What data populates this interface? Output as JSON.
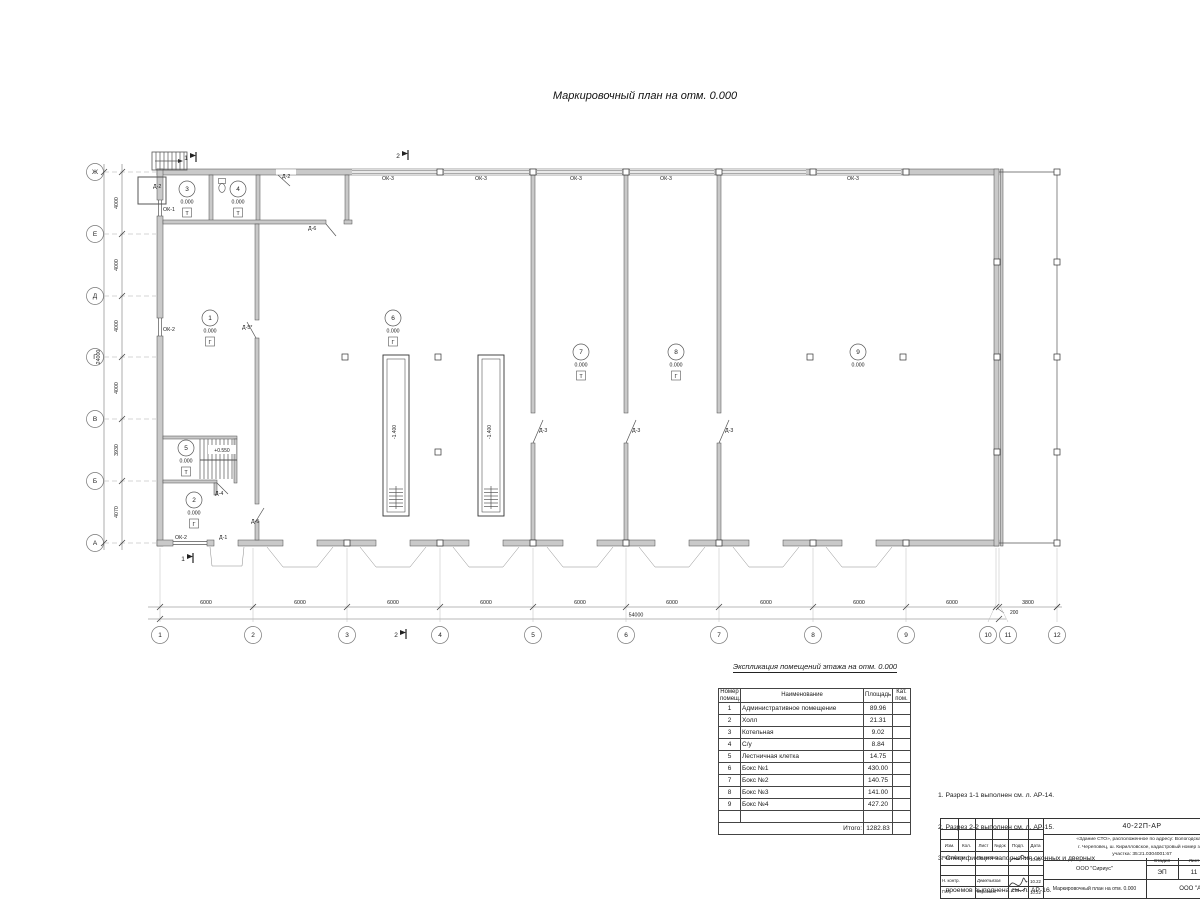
{
  "page": {
    "title": "Маркировочный план на отм. 0.000"
  },
  "plan": {
    "row_axes": [
      {
        "label": "Ж",
        "y": 172
      },
      {
        "label": "Е",
        "y": 234
      },
      {
        "label": "Д",
        "y": 296
      },
      {
        "label": "Г",
        "y": 357
      },
      {
        "label": "В",
        "y": 419
      },
      {
        "label": "Б",
        "y": 481
      },
      {
        "label": "А",
        "y": 543
      }
    ],
    "col_axes": [
      {
        "label": "1",
        "x": 160
      },
      {
        "label": "2",
        "x": 253
      },
      {
        "label": "3",
        "x": 347
      },
      {
        "label": "4",
        "x": 440
      },
      {
        "label": "5",
        "x": 533
      },
      {
        "label": "6",
        "x": 626
      },
      {
        "label": "7",
        "x": 719
      },
      {
        "label": "8",
        "x": 813
      },
      {
        "label": "9",
        "x": 906
      },
      {
        "label": "10",
        "x": 988,
        "lx": 996
      },
      {
        "label": "11",
        "x": 1008,
        "lx": 999
      },
      {
        "label": "12",
        "x": 1057
      }
    ],
    "left_dims": [
      {
        "text": "4000",
        "y": 203
      },
      {
        "text": "4000",
        "y": 265
      },
      {
        "text": "4000",
        "y": 326
      },
      {
        "text": "4000",
        "y": 388
      },
      {
        "text": "3930",
        "y": 450
      },
      {
        "text": "4070",
        "y": 512
      }
    ],
    "left_total": "24000",
    "bottom_dims": [
      {
        "text": "6000",
        "x": 206
      },
      {
        "text": "6000",
        "x": 300
      },
      {
        "text": "6000",
        "x": 393
      },
      {
        "text": "6000",
        "x": 486
      },
      {
        "text": "6000",
        "x": 580
      },
      {
        "text": "6000",
        "x": 672
      },
      {
        "text": "6000",
        "x": 766
      },
      {
        "text": "6000",
        "x": 859
      },
      {
        "text": "6000",
        "x": 952
      },
      {
        "text": "3800",
        "x": 1028
      }
    ],
    "bottom_small_dim": "200",
    "bottom_total": "54000",
    "rooms": [
      {
        "num": "1",
        "elev": "0.000",
        "floor": "Г",
        "x": 210,
        "y": 318
      },
      {
        "num": "2",
        "elev": "0.000",
        "floor": "Г",
        "x": 194,
        "y": 500
      },
      {
        "num": "3",
        "elev": "0.000",
        "floor": "Т",
        "x": 187,
        "y": 189
      },
      {
        "num": "4",
        "elev": "0.000",
        "floor": "Т",
        "x": 238,
        "y": 189
      },
      {
        "num": "5",
        "elev": "0.000",
        "floor": "Т",
        "x": 186,
        "y": 448
      },
      {
        "num": "6",
        "elev": "0.000",
        "floor": "Г",
        "x": 393,
        "y": 318
      },
      {
        "num": "7",
        "elev": "0.000",
        "floor": "Т",
        "x": 581,
        "y": 352
      },
      {
        "num": "8",
        "elev": "0.000",
        "floor": "Г",
        "x": 676,
        "y": 352
      },
      {
        "num": "9",
        "elev": "0.000",
        "floor": "",
        "x": 858,
        "y": 352
      }
    ],
    "pits": [
      {
        "label": "-1.400",
        "x": 396,
        "y": 432
      },
      {
        "label": "-1.400",
        "x": 491,
        "y": 432
      }
    ],
    "stair_elev": "+0.550",
    "marks": [
      {
        "text": "ОК-3",
        "x": 382,
        "y": 180
      },
      {
        "text": "ОК-3",
        "x": 475,
        "y": 180
      },
      {
        "text": "ОК-3",
        "x": 570,
        "y": 180
      },
      {
        "text": "ОК-3",
        "x": 660,
        "y": 180
      },
      {
        "text": "ОК-3",
        "x": 847,
        "y": 180
      },
      {
        "text": "Д-2",
        "x": 153,
        "y": 188
      },
      {
        "text": "Д-2",
        "x": 282,
        "y": 178
      },
      {
        "text": "ОК-1",
        "x": 163,
        "y": 211
      },
      {
        "text": "Д-6",
        "x": 308,
        "y": 230
      },
      {
        "text": "ОК-2",
        "x": 163,
        "y": 331
      },
      {
        "text": "Д-5*",
        "x": 242,
        "y": 329
      },
      {
        "text": "Д-3",
        "x": 539,
        "y": 432
      },
      {
        "text": "Д-3",
        "x": 632,
        "y": 432
      },
      {
        "text": "Д-3",
        "x": 725,
        "y": 432
      },
      {
        "text": "Д-4",
        "x": 215,
        "y": 495
      },
      {
        "text": "Д-5",
        "x": 251,
        "y": 523
      },
      {
        "text": "ОК-2",
        "x": 175,
        "y": 539
      },
      {
        "text": "Д-1",
        "x": 219,
        "y": 539
      }
    ],
    "sections": [
      {
        "text": "1",
        "x": 186,
        "y": 160
      },
      {
        "text": "2",
        "x": 398,
        "y": 158
      },
      {
        "text": "1",
        "x": 183,
        "y": 561
      },
      {
        "text": "2",
        "x": 396,
        "y": 637
      }
    ]
  },
  "explication": {
    "title": "Экспликация помещений этажа на отм. 0.000",
    "headers": [
      "Номер\nпомещ.",
      "Наименование",
      "Площадь",
      "Кат.\nпом."
    ],
    "rows": [
      [
        "1",
        "Административное помещение",
        "89.96",
        ""
      ],
      [
        "2",
        "Холл",
        "21.31",
        ""
      ],
      [
        "3",
        "Котельная",
        "9.02",
        ""
      ],
      [
        "4",
        "С/у",
        "8.84",
        ""
      ],
      [
        "5",
        "Лестничная клетка",
        "14.75",
        ""
      ],
      [
        "6",
        "Бокс №1",
        "430.00",
        ""
      ],
      [
        "7",
        "Бокс №2",
        "140.75",
        ""
      ],
      [
        "8",
        "Бокс №3",
        "141.00",
        ""
      ],
      [
        "9",
        "Бокс №4",
        "427.20",
        ""
      ]
    ],
    "total_label": "Итого:",
    "total_value": "1282.83"
  },
  "notes": [
    "1. Разрез 1-1 выполнен см. л. АР-14.",
    "2. Разрез 2-2 выполнен см. л. АР-15.",
    "3. Спецификация заполнения оконных и дверных",
    "    проемов выполнена см. л. АР-16.",
    "4. Экспликация полов выполнена см. л. АР-16."
  ],
  "stamp": {
    "doc_number": "40-22П-АР",
    "description_lines": [
      "«Здание СТО», расположенное по адресу: Вологодская о",
      "г. Череповец, ш. Кирилловское, кадастровый номер зем",
      "участка: 35:21.0304001:67"
    ],
    "header_cols": [
      "Изм.",
      "Кол.",
      "Лист",
      "№док",
      "Подп.",
      "Дата"
    ],
    "rows": [
      {
        "role": "Разработал",
        "name": "Решетова",
        "date": "10.22"
      },
      {
        "role": "Н. контр.",
        "name": "Деветьязов",
        "date": "10.22"
      },
      {
        "role": "ГИП",
        "name": "Корогаев",
        "date": "10.22"
      }
    ],
    "org": "ООО \"Сириус\"",
    "stage_label": "Стадия",
    "sheet_label": "Лист",
    "stage": "ЭП",
    "sheet": "11",
    "sheet_title": "Маркировочный план на отм. 0.000",
    "org2": "ООО \"Аль"
  }
}
